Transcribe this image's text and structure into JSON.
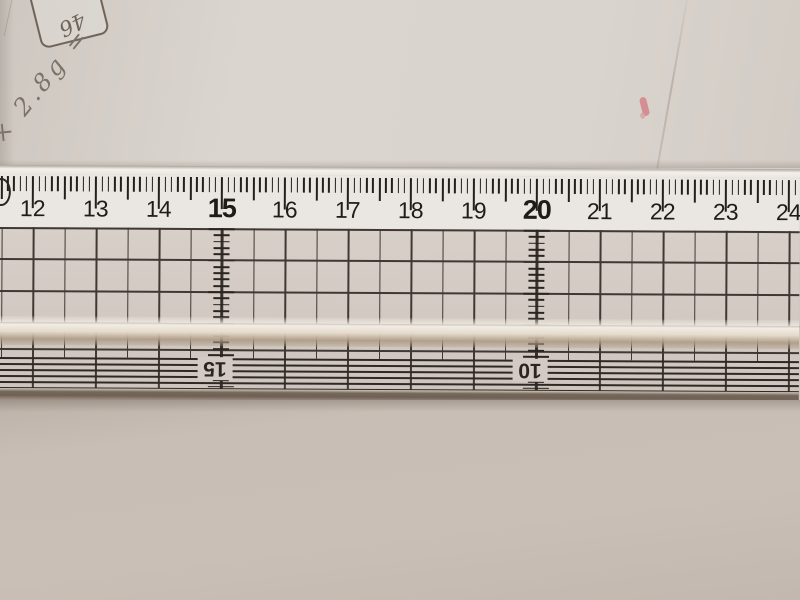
{
  "ruler": {
    "numbers": [
      "12",
      "13",
      "14",
      "15",
      "16",
      "17",
      "18",
      "19",
      "20",
      "21",
      "22",
      "23",
      "24"
    ],
    "bold_numbers": [
      "15",
      "20"
    ],
    "reversed_numbers": [
      {
        "label": "15",
        "at_cm": 15
      },
      {
        "label": "10",
        "at_cm": 20
      }
    ]
  },
  "annotations": {
    "pencil_note": "× 2.8g =",
    "boxed_note": "46"
  },
  "colors": {
    "paper_top": "#d9d3cd",
    "paper_bottom": "#c7bdb4",
    "ruler_white": "#eae6e1",
    "ink": "#221e1b",
    "grid_line": "#3f3833",
    "pencil": "#7b7268",
    "pink_mark": "#d4737c",
    "shadow_edge": "#6f6156"
  }
}
